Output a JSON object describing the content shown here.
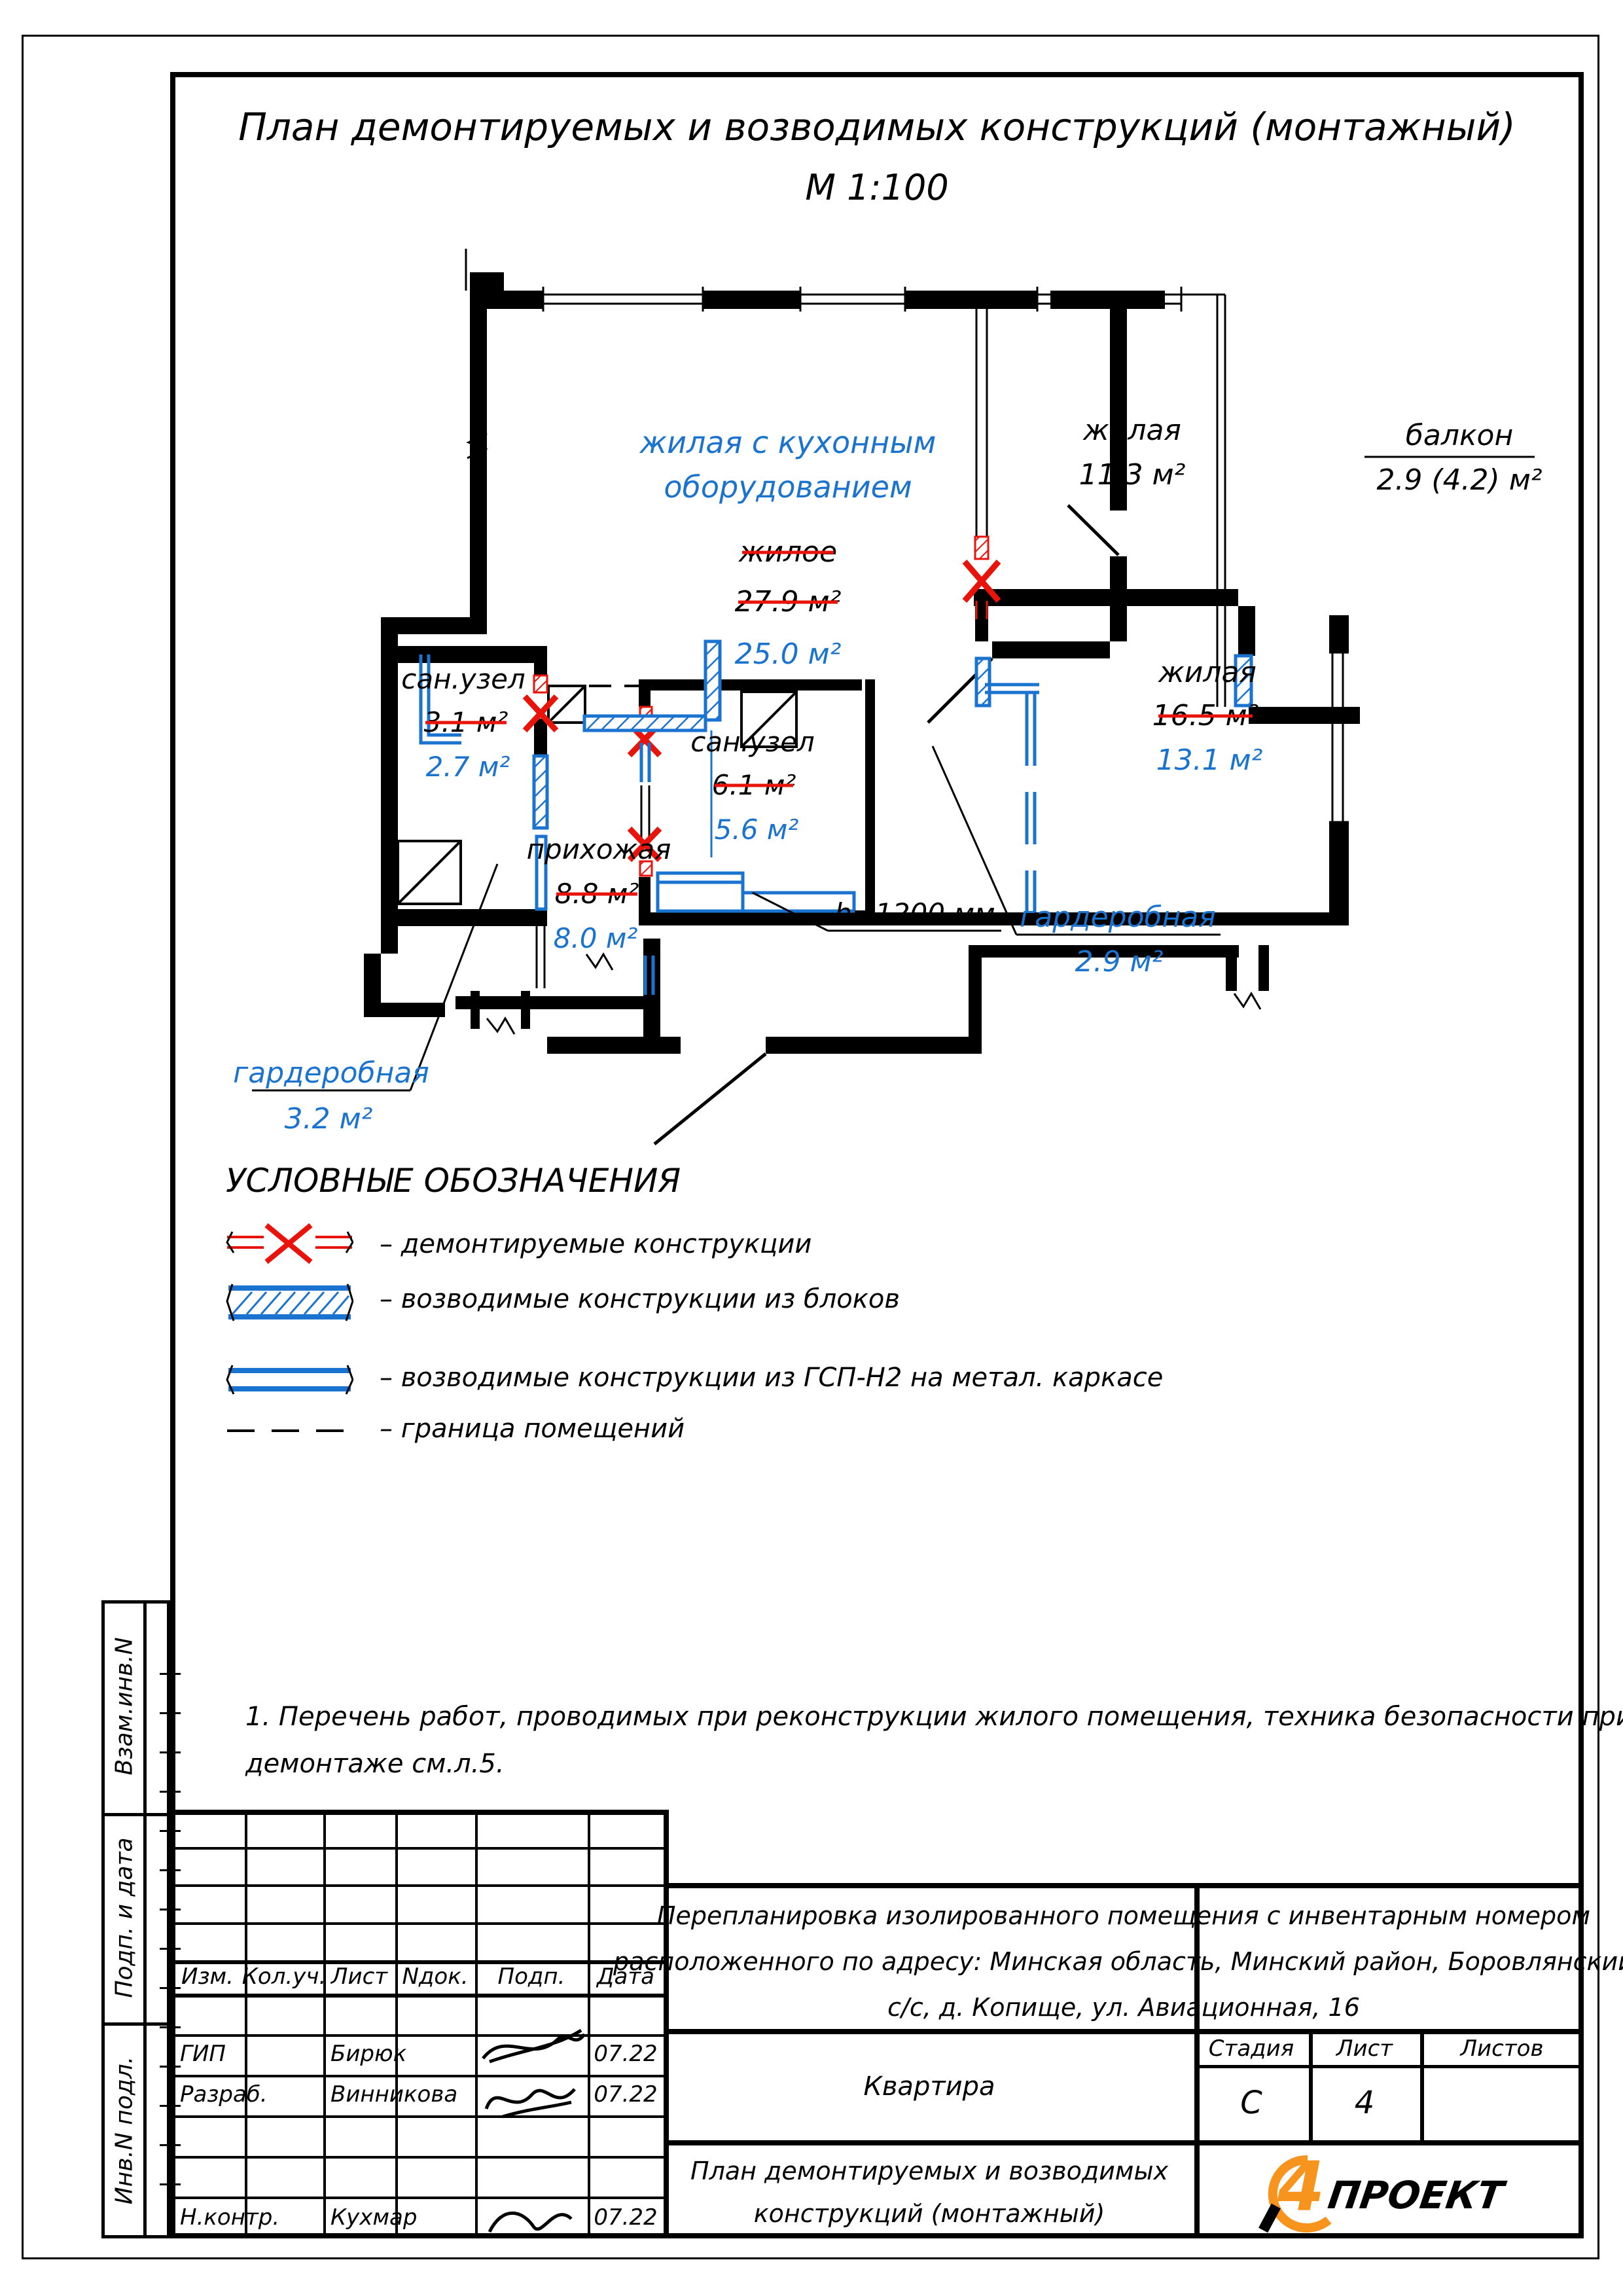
{
  "title": {
    "line1": "План демонтируемых и возводимых конструкций (монтажный)",
    "line2": "М 1:100"
  },
  "plan": {
    "kitchen_name1": "жилая с кухонным",
    "kitchen_name2": "оборудованием",
    "kitchen_old_name": "жилое",
    "kitchen_old_area": "27.9 м²",
    "kitchen_new_area": "25.0 м²",
    "living1_name": "жилая",
    "living1_area": "11.3 м²",
    "balcony_name": "балкон",
    "balcony_area": "2.9 (4.2) м²",
    "bath1_name": "сан.узел",
    "bath1_old": "3.1 м²",
    "bath1_new": "2.7 м²",
    "bath2_name": "сан.узел",
    "bath2_old": "6.1 м²",
    "bath2_new": "5.6 м²",
    "living2_name": "жилая",
    "living2_old": "16.5 м²",
    "living2_new": "13.1 м²",
    "hall_name": "прихожая",
    "hall_old": "8.8 м²",
    "hall_new": "8.0 м²",
    "wardrobe_mid_name": "гардеробная",
    "wardrobe_mid_area": "2.9 м²",
    "wardrobe_bl_name": "гардеробная",
    "wardrobe_bl_area": "3.2 м²",
    "height_note": "h=1200 мм"
  },
  "legend": {
    "heading": "УСЛОВНЫЕ ОБОЗНАЧЕНИЯ",
    "items": [
      {
        "label": "–  демонтируемые  конструкции"
      },
      {
        "label": "–  возводимые  конструкции  из  блоков"
      },
      {
        "label": "–  возводимые  конструкции  из  ГСП-Н2  на  метал.  каркасе"
      },
      {
        "label": "–  граница  помещений"
      }
    ]
  },
  "note": {
    "line1": "1. Перечень работ, проводимых при реконструкции жилого помещения, техника безопасности при",
    "line2": "демонтаже см.л.5."
  },
  "sidebar": {
    "label1": "Взам.инв.N",
    "label2": "Подп. и дата",
    "label3": "Инв.N подл."
  },
  "stamp": {
    "col_izm": "Изм.",
    "col_koluch": "Кол.уч.",
    "col_list": "Лист",
    "col_ndok": "Nдок.",
    "col_podp": "Подп.",
    "col_data": "Дата",
    "row1_role": "ГИП",
    "row1_name": "Бирюк",
    "row1_date": "07.22",
    "row2_role": "Разраб.",
    "row2_name": "Винникова",
    "row2_date": "07.22",
    "row3_role": "Н.контр.",
    "row3_name": "Кухмар",
    "row3_date": "07.22",
    "project_line1": "Перепланировка изолированного помещения с инвентарным номером",
    "project_line2": "расположенного по адресу: Минская область, Минский район, Боровлянский",
    "project_line3": "с/с, д. Копище, ул. Авиационная, 16",
    "object_name": "Квартира",
    "stage_label": "Стадия",
    "sheet_label": "Лист",
    "sheets_label": "Листов",
    "stage_value": "С",
    "sheet_value": "4",
    "sheets_value": "",
    "doc_line1": "План демонтируемых и возводимых",
    "doc_line2": "конструкций (монтажный)",
    "logo_digit": "4",
    "logo_word": "ПРОЕКТ"
  }
}
